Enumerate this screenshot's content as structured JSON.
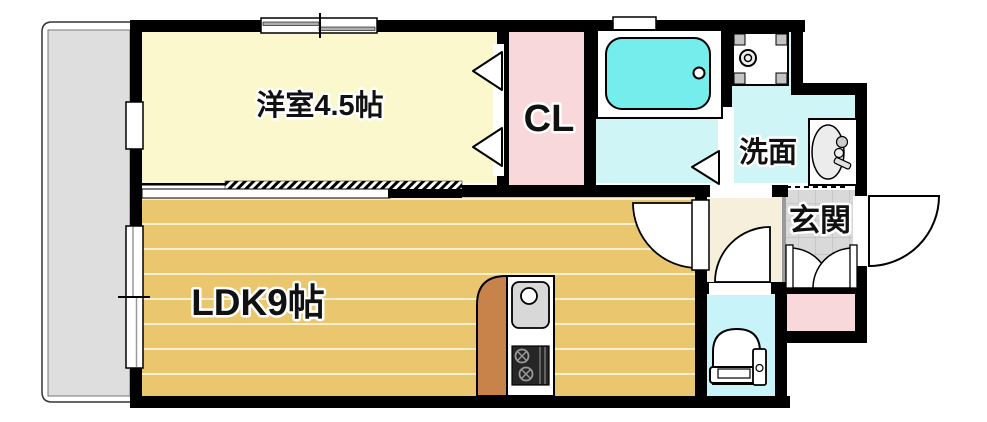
{
  "floorplan": {
    "title": "1K apartment floor plan",
    "labels": {
      "western_room": "洋室4.5帖",
      "closet": "CL",
      "washroom": "洗面",
      "entrance": "玄関",
      "ldk": "LDK9帖"
    },
    "fixtures": [
      "bathtub",
      "washing-machine-pan",
      "vanity-sink",
      "toilet",
      "kitchen-sink",
      "gas-stove",
      "kitchen-counter"
    ],
    "colors": {
      "wall": "#000000",
      "western_room": "#FBF8CE",
      "closet_pink": "#F8D8DB",
      "wet_room_cyan": "#CFF5F7",
      "toilet_cyan": "#C8F3F8",
      "bathtub_cyan": "#76EDED",
      "ldk_floor_tan": "#EAC76F",
      "hallway_cream": "#F6EFDB",
      "entrance_tile_gray": "#D9D9D9",
      "balcony_gray": "#DEDEDE",
      "kitchen_counter_brown": "#C8834B"
    }
  }
}
